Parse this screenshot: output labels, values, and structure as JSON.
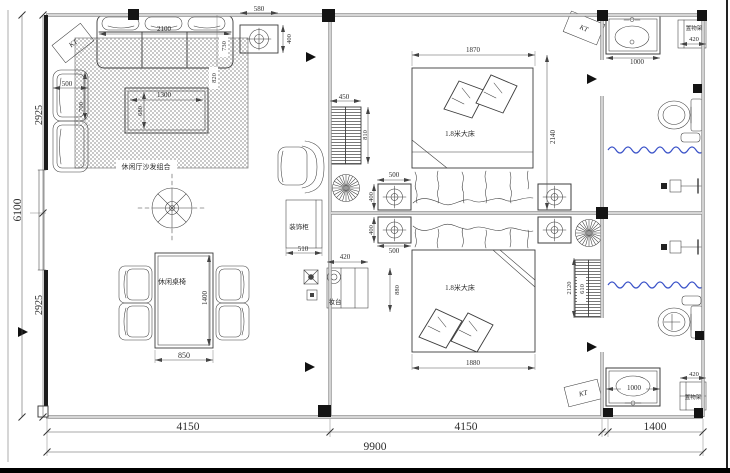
{
  "labels": {
    "sofa_group": "休闲厅沙发组合",
    "dining_set": "休闲桌椅",
    "bed": "1.8米大床",
    "dresser": "妆台",
    "decor_cabinet": "装饰柜",
    "shelf": "置物架",
    "ac": "KT"
  },
  "dims": {
    "sofa_width": "2100",
    "sofa_depth": "730",
    "sofa_side": "820",
    "side_table_width": "580",
    "side_table_depth": "400",
    "armchair_width": "500",
    "armchair_depth": "700",
    "coffee_table_width": "1300",
    "coffee_table_depth": "680",
    "dining_width": "850",
    "dining_length": "1400",
    "wardrobe1_width": "450",
    "wardrobe1_depth": "810",
    "nightstand_width": "500",
    "nightstand_depth": "400",
    "bed1_width": "1870",
    "bed1_length": "2140",
    "bed2_width": "1880",
    "bed2_length": "2120",
    "bed2_offset": "880",
    "wardrobe2_width": "610",
    "cabinet_width": "510",
    "dresser_width": "420",
    "vanity_top_width": "1000",
    "shelf_top_width": "420",
    "vanity_bottom_width": "1000",
    "shelf_bottom_width": "420",
    "left_upper": "2925",
    "left_total": "6100",
    "left_lower": "2925",
    "bottom_left": "4150",
    "bottom_middle": "4150",
    "bottom_right": "1400",
    "bottom_total": "9900"
  },
  "colors": {
    "shower_wave": "#3a52c8",
    "line": "#3c3c3c",
    "wall": "#909090"
  }
}
